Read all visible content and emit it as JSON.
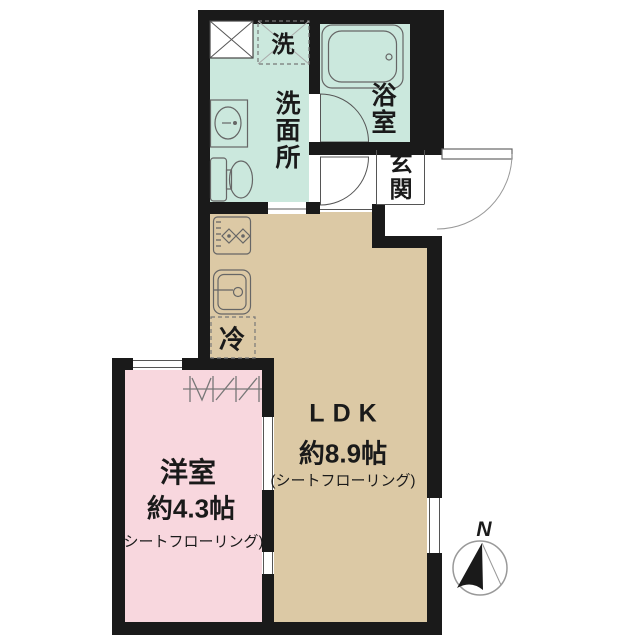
{
  "rooms": {
    "ldk": {
      "name": "LDK",
      "size": "約8.9帖",
      "flooring": "(シートフローリング)"
    },
    "western_room": {
      "name": "洋室",
      "size": "約4.3帖",
      "flooring": "(シートフローリング)"
    },
    "washroom": {
      "name": "洗面所"
    },
    "bathroom": {
      "name": "浴室"
    },
    "entrance": {
      "name": "玄関"
    }
  },
  "labels": {
    "washing_machine": "洗",
    "refrigerator": "冷",
    "north": "N"
  },
  "colors": {
    "wall": "#1a1a1a",
    "wet_area": "#cbe8dd",
    "ldk_floor": "#dcc9a5",
    "western_room_floor": "#f8d7de",
    "background": "#ffffff",
    "line": "#555555"
  }
}
